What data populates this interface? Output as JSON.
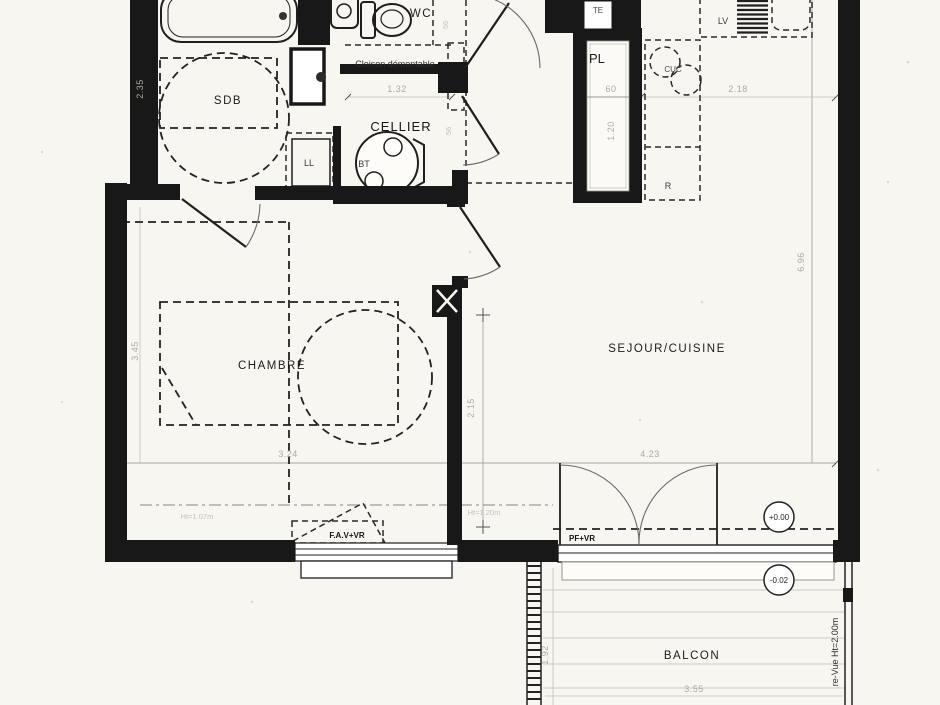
{
  "plan": {
    "rooms": {
      "sdb": "SDB",
      "wc": "WC",
      "cellier": "CELLIER",
      "chambre": "CHAMBRE",
      "sejour_cuisine": "SEJOUR/CUISINE",
      "balcon": "BALCON",
      "placard": "PL",
      "tableau_electrique": "TE"
    },
    "equipment": {
      "lave_linge": "LL",
      "ballon_thermo": "BT",
      "lave_vaisselle": "LV",
      "cuisson": "CUC",
      "refrigerateur": "R"
    },
    "annotations": {
      "cloison_demontable": "Cloison démontable",
      "fenetre_chambre": "F.A.V+VR",
      "porte_fenetre": "PF+VR",
      "pare_vue": "re-Vue Ht=2.00m",
      "allege_chambre": "Ht=1.07m",
      "allege_sejour": "Ht=1.20m",
      "niveau_interieur": "+0.00",
      "niveau_balcon": "-0.02"
    },
    "dimensions": {
      "sdb_largeur": "2.35",
      "cellier_largeur": "1.32",
      "placard_largeur": "60",
      "cuisine_longueur": "2.18",
      "placard_profondeur": "1.20",
      "chambre_longueur": "3.45",
      "chambre_largeur": "3.24",
      "passage_hauteur": "2.15",
      "sejour_largeur": "4.23",
      "sejour_longueur": "6.96",
      "balcon_largeur": "3.55",
      "balcon_profondeur": "1.92",
      "cote_wc": "56",
      "cote_cellier": "56"
    },
    "colors": {
      "paper": "#f7f6f1",
      "wall": "#181818",
      "dim_faint": "#aeaba1"
    }
  }
}
